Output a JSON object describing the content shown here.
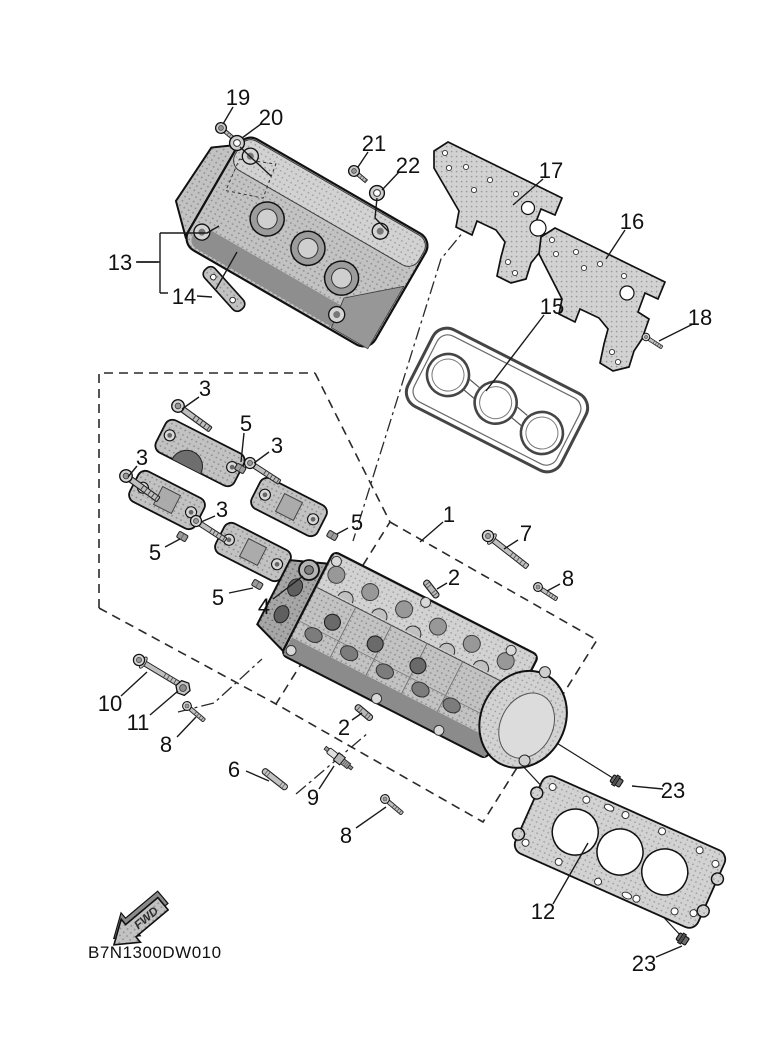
{
  "diagram": {
    "code": "B7N1300DW010",
    "fwd_label": "FWD",
    "colors": {
      "line": "#1a1a1a",
      "part_fill": "#c4c4c4",
      "part_dark": "#8b8b8b",
      "part_light": "#d9d9d9",
      "background": "#ffffff"
    },
    "callouts": [
      {
        "ref": "19",
        "x": 238,
        "y": 97,
        "leader": [
          233,
          107,
          223,
          124
        ]
      },
      {
        "ref": "20",
        "x": 271,
        "y": 117,
        "leader": [
          261,
          124,
          242,
          138
        ]
      },
      {
        "ref": "21",
        "x": 374,
        "y": 143,
        "leader": [
          368,
          152,
          358,
          167
        ]
      },
      {
        "ref": "22",
        "x": 408,
        "y": 165,
        "leader": [
          399,
          172,
          382,
          190
        ]
      },
      {
        "ref": "17",
        "x": 551,
        "y": 170,
        "leader": [
          543,
          179,
          513,
          205
        ]
      },
      {
        "ref": "16",
        "x": 632,
        "y": 221,
        "leader": [
          625,
          230,
          606,
          259
        ]
      },
      {
        "ref": "18",
        "x": 700,
        "y": 317,
        "leader": [
          693,
          324,
          659,
          341
        ]
      },
      {
        "ref": "15",
        "x": 552,
        "y": 306,
        "leader": [
          544,
          315,
          486,
          391
        ]
      },
      {
        "ref": "13",
        "x": 120,
        "y": 262,
        "leader": [
          136,
          262,
          158,
          262
        ]
      },
      {
        "ref": "14",
        "x": 184,
        "y": 296,
        "leader": [
          197,
          296,
          212,
          297
        ]
      },
      {
        "ref": "3",
        "x": 205,
        "y": 388,
        "leader": [
          199,
          397,
          182,
          409
        ]
      },
      {
        "ref": "5",
        "x": 246,
        "y": 423,
        "leader": [
          244,
          433,
          241,
          462
        ]
      },
      {
        "ref": "3",
        "x": 277,
        "y": 445,
        "leader": [
          269,
          452,
          254,
          463
        ]
      },
      {
        "ref": "3",
        "x": 142,
        "y": 457,
        "leader": [
          137,
          466,
          128,
          477
        ]
      },
      {
        "ref": "3",
        "x": 222,
        "y": 509,
        "leader": [
          215,
          516,
          201,
          522
        ]
      },
      {
        "ref": "5",
        "x": 155,
        "y": 552,
        "leader": [
          165,
          547,
          180,
          539
        ]
      },
      {
        "ref": "5",
        "x": 357,
        "y": 522,
        "leader": [
          348,
          528,
          337,
          534
        ]
      },
      {
        "ref": "5",
        "x": 218,
        "y": 597,
        "leader": [
          229,
          593,
          253,
          588
        ]
      },
      {
        "ref": "4",
        "x": 264,
        "y": 606,
        "leader": [
          273,
          599,
          303,
          576
        ]
      },
      {
        "ref": "1",
        "x": 449,
        "y": 514,
        "leader": [
          443,
          522,
          420,
          542
        ]
      },
      {
        "ref": "7",
        "x": 526,
        "y": 533,
        "leader": [
          518,
          540,
          504,
          549
        ]
      },
      {
        "ref": "2",
        "x": 454,
        "y": 577,
        "leader": [
          447,
          583,
          437,
          589
        ]
      },
      {
        "ref": "8",
        "x": 568,
        "y": 578,
        "leader": [
          560,
          584,
          547,
          591
        ]
      },
      {
        "ref": "10",
        "x": 110,
        "y": 703,
        "leader": [
          121,
          696,
          147,
          672
        ]
      },
      {
        "ref": "11",
        "x": 138,
        "y": 722,
        "leader": [
          150,
          715,
          178,
          691
        ]
      },
      {
        "ref": "8",
        "x": 166,
        "y": 744,
        "leader": [
          177,
          737,
          196,
          717
        ]
      },
      {
        "ref": "2",
        "x": 344,
        "y": 727,
        "leader": [
          352,
          720,
          362,
          713
        ]
      },
      {
        "ref": "6",
        "x": 234,
        "y": 769,
        "leader": [
          246,
          771,
          269,
          781
        ]
      },
      {
        "ref": "9",
        "x": 313,
        "y": 797,
        "leader": [
          319,
          789,
          334,
          766
        ]
      },
      {
        "ref": "8",
        "x": 346,
        "y": 835,
        "leader": [
          356,
          828,
          386,
          807
        ]
      },
      {
        "ref": "23",
        "x": 673,
        "y": 790,
        "leader": [
          663,
          789,
          632,
          786
        ]
      },
      {
        "ref": "12",
        "x": 543,
        "y": 911,
        "leader": [
          553,
          904,
          588,
          843
        ]
      },
      {
        "ref": "23",
        "x": 644,
        "y": 963,
        "leader": [
          656,
          957,
          682,
          946
        ]
      }
    ]
  }
}
